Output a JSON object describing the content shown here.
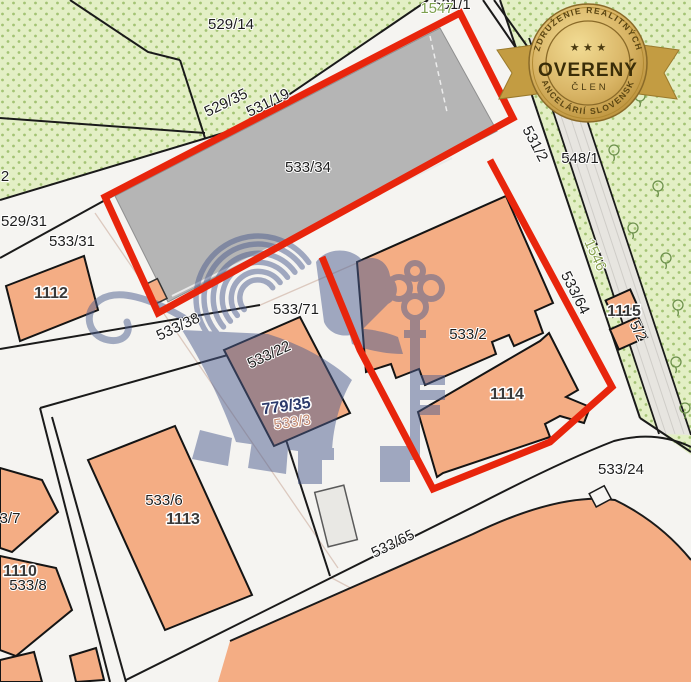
{
  "map": {
    "type": "cadastral-parcel-map",
    "colors": {
      "background": "#f5f4f1",
      "highlight_red": "#e8250c",
      "building_orange": "#f4ad84",
      "vegetation_green": "#e3efc5",
      "vegetation_dot": "#a3c374",
      "big_building_gray": "#b5b5b5",
      "watermark_blue": "#4c5d8e",
      "badge_gold": "#d1a953"
    },
    "labels": [
      {
        "text": "529/14",
        "x": 231,
        "y": 29,
        "rot": 0
      },
      {
        "text": "531/1",
        "x": 452,
        "y": 9,
        "rot": 0
      },
      {
        "text": "1547",
        "x": 437,
        "y": 13,
        "rot": 0,
        "color": "#7da04e"
      },
      {
        "text": "2",
        "x": 5,
        "y": 181,
        "rot": 0
      },
      {
        "text": "529/31",
        "x": 24,
        "y": 226,
        "rot": 0
      },
      {
        "text": "533/31",
        "x": 72,
        "y": 246,
        "rot": 0
      },
      {
        "text": "529/35",
        "x": 228,
        "y": 107,
        "rot": -26
      },
      {
        "text": "531/19",
        "x": 270,
        "y": 107,
        "rot": -26
      },
      {
        "text": "533/34",
        "x": 308,
        "y": 172,
        "rot": 0
      },
      {
        "text": "1112",
        "x": 51,
        "y": 298,
        "rot": 0,
        "bold": true
      },
      {
        "text": "533/38",
        "x": 180,
        "y": 331,
        "rot": -25
      },
      {
        "text": "533/71",
        "x": 296,
        "y": 314,
        "rot": 0
      },
      {
        "text": "533/22",
        "x": 271,
        "y": 359,
        "rot": -25
      },
      {
        "text": "779/35",
        "x": 287,
        "y": 411,
        "rot": -8,
        "bold": true,
        "color": "#2c3a6b"
      },
      {
        "text": "533/3",
        "x": 293,
        "y": 427,
        "rot": -8,
        "color": "#c58a70"
      },
      {
        "text": "533/2",
        "x": 468,
        "y": 339,
        "rot": 0
      },
      {
        "text": "1114",
        "x": 507,
        "y": 399,
        "rot": 0,
        "bold": true
      },
      {
        "text": "531/2",
        "x": 531,
        "y": 146,
        "rot": 62
      },
      {
        "text": "548/1",
        "x": 580,
        "y": 163,
        "rot": 0
      },
      {
        "text": "1546",
        "x": 591,
        "y": 257,
        "rot": 65,
        "color": "#8aa352"
      },
      {
        "text": "533/64",
        "x": 571,
        "y": 295,
        "rot": 63
      },
      {
        "text": "1115",
        "x": 624,
        "y": 316,
        "rot": 0,
        "bold": true
      },
      {
        "text": "5/2",
        "x": 634,
        "y": 333,
        "rot": 63
      },
      {
        "text": "533/24",
        "x": 621,
        "y": 474,
        "rot": 0
      },
      {
        "text": "533/65",
        "x": 395,
        "y": 548,
        "rot": -26
      },
      {
        "text": "533/6",
        "x": 164,
        "y": 505,
        "rot": 0
      },
      {
        "text": "1113",
        "x": 183,
        "y": 524,
        "rot": 0,
        "bold": true
      },
      {
        "text": "3/7",
        "x": 10,
        "y": 523,
        "rot": 0
      },
      {
        "text": "1110",
        "x": 20,
        "y": 576,
        "rot": 0,
        "bold": true
      },
      {
        "text": "533/8",
        "x": 28,
        "y": 590,
        "rot": 0
      }
    ],
    "trees": [
      [
        600,
        62
      ],
      [
        640,
        96
      ],
      [
        614,
        150
      ],
      [
        658,
        186
      ],
      [
        633,
        228
      ],
      [
        666,
        258
      ],
      [
        678,
        305
      ],
      [
        676,
        362
      ],
      [
        685,
        408
      ],
      [
        552,
        30
      ]
    ]
  },
  "badge": {
    "top": "ZDRUŽENIE REALITNÝCH",
    "main": "OVERENÝ",
    "sub": "ČLEN",
    "bottom": "KANCELÁRIÍ SLOVENSKA",
    "stars": "★ ★ ★"
  },
  "watermark": {
    "description": "lion-with-key-watermark"
  }
}
